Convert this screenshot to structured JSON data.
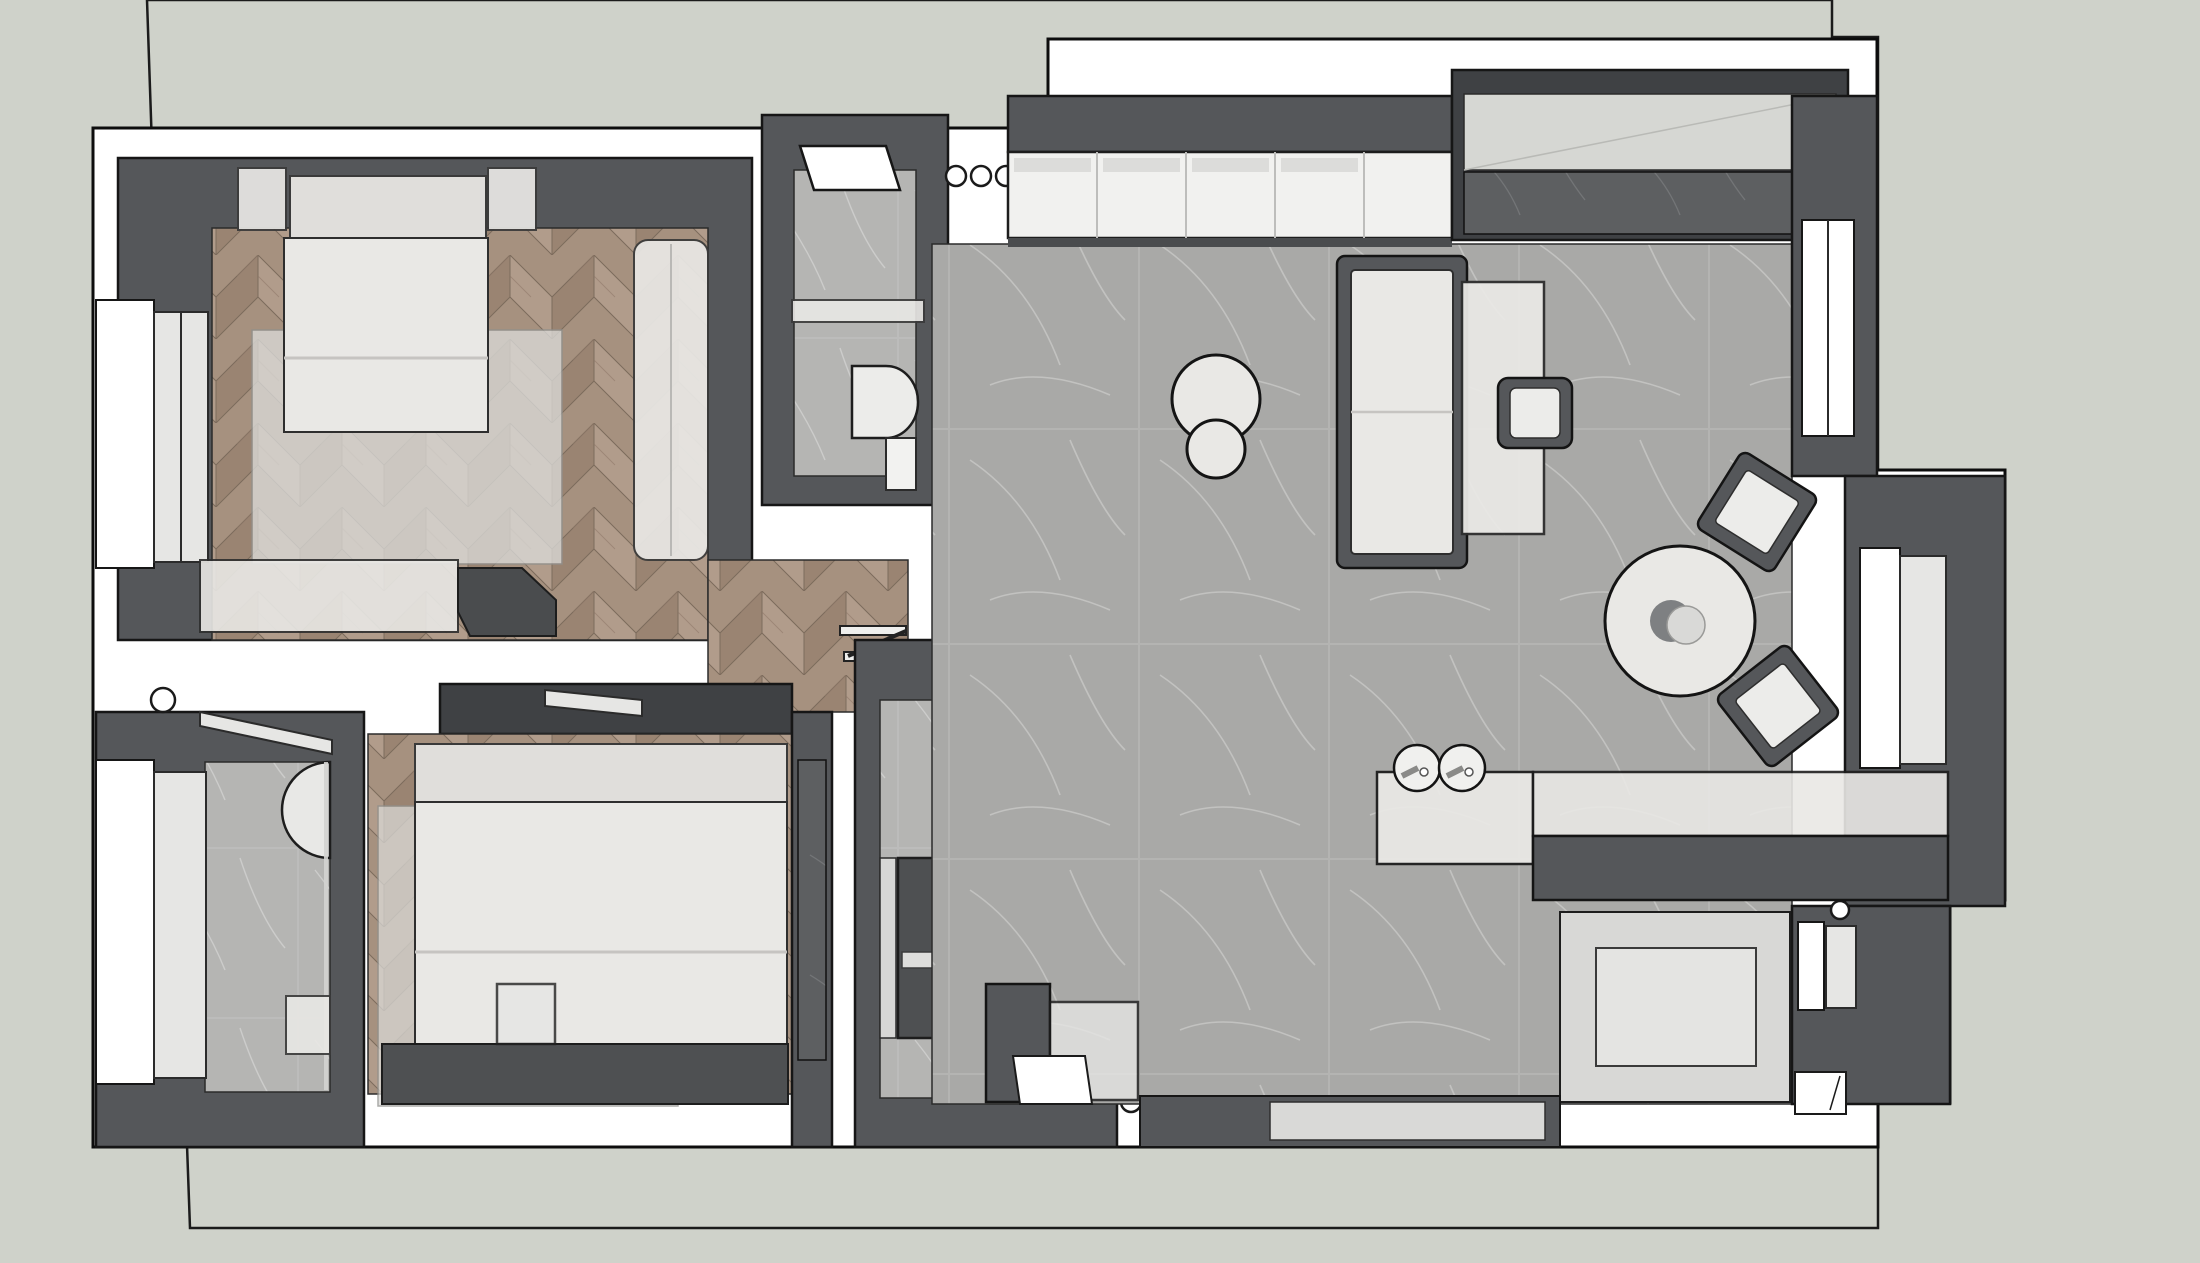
{
  "scene": {
    "kind": "3d-floor-plan-top-view",
    "rooms": [
      "master-bedroom",
      "second-bedroom",
      "main-bathroom",
      "ensuite-bathroom",
      "shower-room",
      "dressing-corridor",
      "living-dining-kitchen",
      "entry"
    ],
    "furniture": [
      "double-bed",
      "nightstand",
      "wardrobe",
      "foot-bench",
      "bed-2",
      "low-console",
      "sofa",
      "side-table",
      "desk-chair",
      "coffee-table-set",
      "round-dining-table",
      "dining-chair",
      "sideboard-console",
      "toilet",
      "vanity-sink",
      "shower-enclosure",
      "kitchen-cabinets",
      "tall-closet",
      "glass-island",
      "decor-bowls",
      "zigzag-shelf"
    ]
  },
  "colors": {
    "page_bg": "#cfd2ca",
    "slab": "#ffffff",
    "outline": "#141414",
    "wall_dark": "#55575a",
    "wall_darker": "#3f4144",
    "wood_a": "#b19c8b",
    "wood_b": "#9a8472",
    "tile": "#a9a9a7",
    "marble": "#b5b5b3",
    "marble_dark": "#5d5f61",
    "furn_light": "#e9e8e5",
    "furn_shade": "#d9d8d5",
    "glass": "#e6e6e4",
    "white": "#ffffff"
  }
}
